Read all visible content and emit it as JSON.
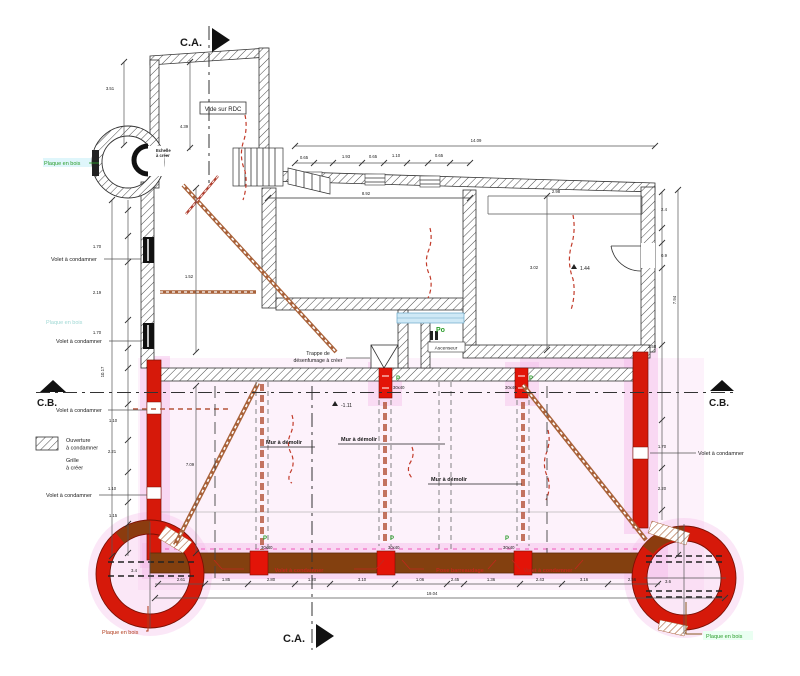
{
  "drawing": {
    "type": "architectural-floor-plan",
    "language": "fr"
  },
  "colors": {
    "accent_red": "#d6190a",
    "wall_brown": "#83400f",
    "brace_brown": "#a9623a",
    "highlight_pink": "#f3b9e9",
    "label_green": "#2a9c2a",
    "label_red": "#c2281c",
    "dash_red": "#c23b2a"
  },
  "section_markers": {
    "top": "C.A.",
    "bottom": "C.A.",
    "left": "C.B.",
    "right": "C.B."
  },
  "legend": {
    "ouverture": "Ouverture à condamner",
    "grille": "Grille à créer"
  },
  "texts": [
    {
      "n": "section-ca-top-label",
      "t": "C.A.",
      "x": 180,
      "y": 46,
      "s": 11,
      "w": "bold"
    },
    {
      "n": "section-ca-bottom-label",
      "t": "C.A.",
      "x": 283,
      "y": 642,
      "s": 11,
      "w": "bold"
    },
    {
      "n": "section-cb-left-label",
      "t": "C.B.",
      "x": 37,
      "y": 406,
      "s": 10,
      "w": "bold"
    },
    {
      "n": "section-cb-right-label",
      "t": "C.B.",
      "x": 709,
      "y": 406,
      "s": 10,
      "w": "bold"
    },
    {
      "n": "vide-sur-rdc-label",
      "t": "Vide sur RDC",
      "x": 223,
      "y": 111,
      "s": 6,
      "a": "middle"
    },
    {
      "n": "turret-note-line1",
      "t": "Echelle",
      "x": 156,
      "y": 152,
      "s": 4.2,
      "w": "bold"
    },
    {
      "n": "turret-note-line2",
      "t": "à créer",
      "x": 156,
      "y": 157,
      "s": 4.2,
      "w": "bold"
    },
    {
      "n": "plaque-en-bois-top-label",
      "t": "Plaque en bois",
      "x": 44,
      "y": 165,
      "s": 5.5,
      "c": "#2a9c2a"
    },
    {
      "n": "volet-condamner-left1-label",
      "t": "Volet à condamner",
      "x": 51,
      "y": 261,
      "s": 5.5
    },
    {
      "n": "volet-condamner-left2-label",
      "t": "Volet à condamner",
      "x": 56,
      "y": 343,
      "s": 5.5
    },
    {
      "n": "plaque-en-bois-faint-label",
      "t": "Plaque en bois",
      "x": 46,
      "y": 324,
      "s": 5.5,
      "c": "#9fd8d4"
    },
    {
      "n": "volet-condamner-left3-label",
      "t": "Volet à condamner",
      "x": 56,
      "y": 412,
      "s": 5.5
    },
    {
      "n": "legend-ouverture-line1",
      "t": "Ouverture",
      "x": 66,
      "y": 442,
      "s": 5.5
    },
    {
      "n": "legend-ouverture-line2",
      "t": "à condamner",
      "x": 66,
      "y": 449.5,
      "s": 5.5
    },
    {
      "n": "legend-grille-line1",
      "t": "Grille",
      "x": 66,
      "y": 462,
      "s": 5.5
    },
    {
      "n": "legend-grille-line2",
      "t": "à créer",
      "x": 66,
      "y": 469.5,
      "s": 5.5
    },
    {
      "n": "volet-condamner-left4-label",
      "t": "Volet à condamner",
      "x": 46,
      "y": 497,
      "s": 5.5
    },
    {
      "n": "mur-demolir-1-label",
      "t": "Mur à démolir",
      "x": 266,
      "y": 444,
      "s": 5.5,
      "w": "bold"
    },
    {
      "n": "mur-demolir-2-label",
      "t": "Mur à démolir",
      "x": 341,
      "y": 441,
      "s": 5.5,
      "w": "bold"
    },
    {
      "n": "mur-demolir-3-label",
      "t": "Mur à démolir",
      "x": 431,
      "y": 481,
      "s": 5.5,
      "w": "bold"
    },
    {
      "n": "trappe-label-line1",
      "t": "Trappe de",
      "x": 318,
      "y": 355,
      "s": 5.2,
      "a": "middle"
    },
    {
      "n": "trappe-label-line2",
      "t": "désenfumage à créer",
      "x": 318,
      "y": 362,
      "s": 5.2,
      "a": "middle"
    },
    {
      "n": "ascenseur-label",
      "t": "Ascenseur",
      "x": 446,
      "y": 349.5,
      "s": 4.8,
      "a": "middle"
    },
    {
      "n": "po-label",
      "t": "Po",
      "x": 436,
      "y": 332,
      "s": 7,
      "c": "#2a9c2a",
      "w": "bold"
    },
    {
      "n": "volet-condamner-right-label",
      "t": "Volet à condamner",
      "x": 698,
      "y": 455,
      "s": 5.5
    },
    {
      "n": "volet-condamner-bottom1-label",
      "t": "Volet à condamner",
      "x": 299,
      "y": 572,
      "s": 5.5,
      "c": "#c2281c",
      "w": "bold",
      "a": "middle"
    },
    {
      "n": "pose-barreaudage-label",
      "t": "Pose barreaudage",
      "x": 460,
      "y": 572,
      "s": 5.5,
      "c": "#c2281c",
      "w": "bold",
      "a": "middle"
    },
    {
      "n": "volet-condamner-bottom2-label",
      "t": "Volet à condamner",
      "x": 548,
      "y": 572,
      "s": 5.5,
      "c": "#c2281c",
      "w": "bold",
      "a": "middle"
    },
    {
      "n": "plaque-en-bois-bottom-left-label",
      "t": "Plaque en bois",
      "x": 102,
      "y": 634,
      "s": 5.5,
      "c": "#b03a1a"
    },
    {
      "n": "plaque-en-bois-bottom-right-label",
      "t": "Plaque en bois",
      "x": 706,
      "y": 638,
      "s": 5.5,
      "c": "#2a9c2a"
    },
    {
      "n": "level-marker-1-value",
      "t": "-1.11",
      "x": 341,
      "y": 407,
      "s": 5
    },
    {
      "n": "level-marker-2-value",
      "t": "1.44",
      "x": 580,
      "y": 270,
      "s": 5
    },
    {
      "n": "post-top1-p",
      "t": "P",
      "x": 396,
      "y": 380,
      "s": 6,
      "c": "#2a9c2a",
      "w": "bold"
    },
    {
      "n": "post-top1-size",
      "t": "30x40",
      "x": 393,
      "y": 389,
      "s": 4.2
    },
    {
      "n": "post-top2-p",
      "t": "P",
      "x": 529,
      "y": 380,
      "s": 6,
      "c": "#2a9c2a",
      "w": "bold"
    },
    {
      "n": "post-top2-size",
      "t": "30x40",
      "x": 505,
      "y": 389,
      "s": 4.2
    },
    {
      "n": "post-bottom1-p",
      "t": "P",
      "x": 263,
      "y": 540,
      "s": 6,
      "c": "#2a9c2a",
      "w": "bold"
    },
    {
      "n": "post-bottom1-size",
      "t": "30x40",
      "x": 261,
      "y": 549,
      "s": 4.2
    },
    {
      "n": "post-bottom2-p",
      "t": "P",
      "x": 390,
      "y": 540,
      "s": 6,
      "c": "#2a9c2a",
      "w": "bold"
    },
    {
      "n": "post-bottom2-size",
      "t": "30x40",
      "x": 388,
      "y": 549,
      "s": 4.2
    },
    {
      "n": "post-bottom3-p",
      "t": "P",
      "x": 505,
      "y": 540,
      "s": 6,
      "c": "#2a9c2a",
      "w": "bold"
    },
    {
      "n": "post-bottom3-size",
      "t": "30x40",
      "x": 503,
      "y": 549,
      "s": 4.2
    }
  ],
  "dims": [
    {
      "t": "3.51",
      "x": 110,
      "y": 90
    },
    {
      "t": "4.39",
      "x": 184,
      "y": 128
    },
    {
      "t": "14.09",
      "x": 476,
      "y": 142
    },
    {
      "t": "0.65",
      "x": 304,
      "y": 159
    },
    {
      "t": "1.93",
      "x": 346,
      "y": 158
    },
    {
      "t": "0.65",
      "x": 373,
      "y": 158
    },
    {
      "t": "1.10",
      "x": 396,
      "y": 157
    },
    {
      "t": "0.65",
      "x": 439,
      "y": 157
    },
    {
      "t": "8.92",
      "x": 366,
      "y": 195
    },
    {
      "t": "2.98",
      "x": 556,
      "y": 193
    },
    {
      "t": "3.02",
      "x": 534,
      "y": 269
    },
    {
      "t": "1.52",
      "x": 189,
      "y": 278
    },
    {
      "t": "2.4",
      "x": 664,
      "y": 211
    },
    {
      "t": "0.9",
      "x": 664,
      "y": 257
    },
    {
      "t": "2.58",
      "x": 652,
      "y": 348
    },
    {
      "t": "7.94",
      "x": 676,
      "y": 300,
      "r": -90
    },
    {
      "t": "1.70",
      "x": 97,
      "y": 248
    },
    {
      "t": "2.19",
      "x": 97,
      "y": 294
    },
    {
      "t": "1.70",
      "x": 97,
      "y": 334
    },
    {
      "t": "10.17",
      "x": 104,
      "y": 372,
      "r": -90
    },
    {
      "t": "1.10",
      "x": 113,
      "y": 422
    },
    {
      "t": "2.21",
      "x": 112,
      "y": 453
    },
    {
      "t": "1.10",
      "x": 112,
      "y": 490
    },
    {
      "t": "1.15",
      "x": 113,
      "y": 517
    },
    {
      "t": "1.70",
      "x": 662,
      "y": 448
    },
    {
      "t": "2.20",
      "x": 662,
      "y": 490
    },
    {
      "t": "7.09",
      "x": 190,
      "y": 466
    },
    {
      "t": "3.4",
      "x": 134,
      "y": 572
    },
    {
      "t": "3.6",
      "x": 668,
      "y": 583
    },
    {
      "t": "2.61",
      "x": 181,
      "y": 581
    },
    {
      "t": "1.85",
      "x": 226,
      "y": 581
    },
    {
      "t": "2.80",
      "x": 271,
      "y": 581
    },
    {
      "t": "1.20",
      "x": 312,
      "y": 581
    },
    {
      "t": "3.10",
      "x": 362,
      "y": 581
    },
    {
      "t": "1.06",
      "x": 420,
      "y": 581
    },
    {
      "t": "2.45",
      "x": 455,
      "y": 581
    },
    {
      "t": "1.36",
      "x": 491,
      "y": 581
    },
    {
      "t": "2.43",
      "x": 540,
      "y": 581
    },
    {
      "t": "3.16",
      "x": 584,
      "y": 581
    },
    {
      "t": "2.56",
      "x": 632,
      "y": 581
    },
    {
      "t": "19.04",
      "x": 432,
      "y": 595
    }
  ]
}
